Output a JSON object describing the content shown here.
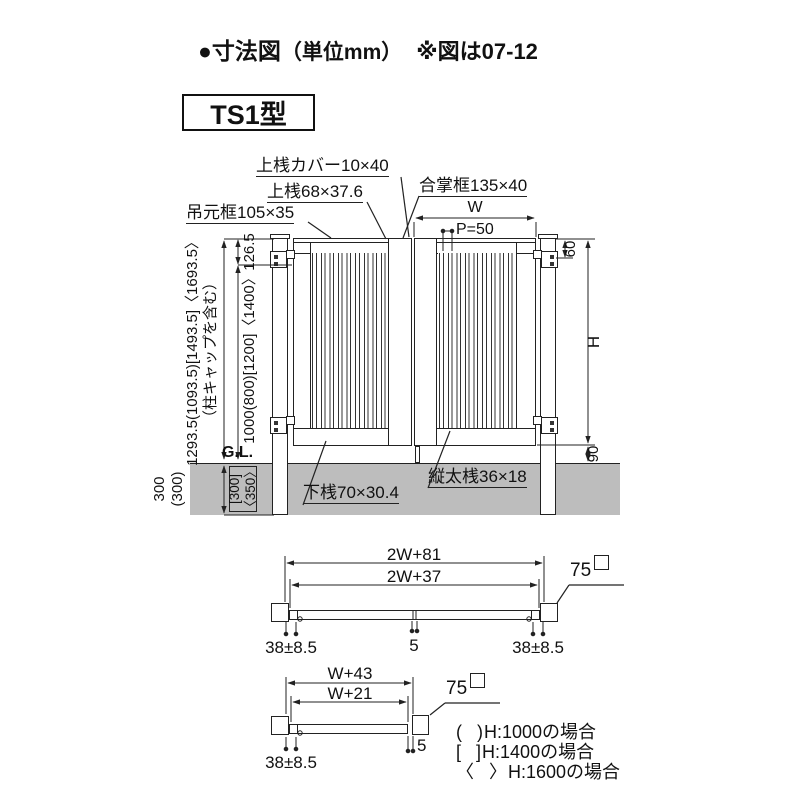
{
  "header": {
    "bullet": "●",
    "title": "寸法図",
    "unit": "（単位mm）",
    "note": "※図は07-12"
  },
  "model": "TS1型",
  "elevation": {
    "part_labels": {
      "top_rail_cover": "上桟カバー10×40",
      "top_rail": "上桟68×37.6",
      "meeting_stile": "合掌框135×40",
      "hanging_stile": "吊元框105×35",
      "bottom_rail": "下桟70×30.4",
      "vertical_bar": "縦太桟36×18"
    },
    "dims": {
      "leaf_width": "W",
      "pitch": "P=50",
      "total_height": "1293.5(1093.5)[1493.5]〈1693.5〉",
      "total_height_note": "（柱キャップを含む）",
      "top_offset": "126.5",
      "gate_height": "1000(800)[1200]〈1400〉",
      "embed_left_1": "300",
      "embed_left_2": "(300)",
      "embed_right_1": "[300]",
      "embed_right_2": "〈350〉",
      "hinge_top": "60",
      "height": "H",
      "bottom_gap": "90",
      "ground_line": "G.L."
    }
  },
  "plan_double": {
    "outer": "2W+81",
    "inner": "2W+37",
    "side_left": "38±8.5",
    "center_gap": "5",
    "side_right": "38±8.5",
    "post_size": "75"
  },
  "plan_single": {
    "outer": "W+43",
    "inner": "W+21",
    "side_left": "38±8.5",
    "end_gap": "5",
    "post_size": "75"
  },
  "legend": [
    {
      "open": "(",
      "close": ")",
      "label": "H:1000の場合"
    },
    {
      "open": "[",
      "close": "]",
      "label": "H:1400の場合"
    },
    {
      "open": "〈",
      "close": "〉",
      "label": "H:1600の場合"
    }
  ],
  "colors": {
    "line": "#222222",
    "ground": "#bdbdbd"
  }
}
